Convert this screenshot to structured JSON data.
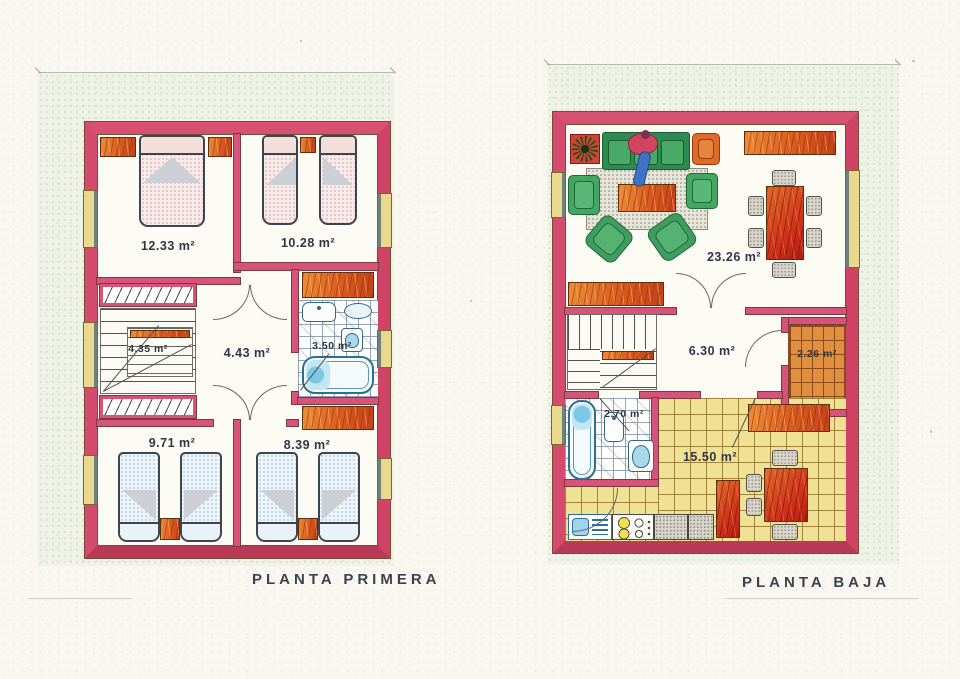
{
  "sheet": {
    "captions": {
      "first_floor": "PLANTA PRIMERA",
      "ground_floor": "PLANTA BAJA"
    }
  },
  "plans": [
    {
      "name": "PLANTA PRIMERA",
      "rooms": [
        {
          "id": "bedroom-1",
          "area": "12.33 m²"
        },
        {
          "id": "bedroom-2",
          "area": "10.28 m²"
        },
        {
          "id": "staircase",
          "area": "4.35 m²"
        },
        {
          "id": "hall",
          "area": "4.43 m²"
        },
        {
          "id": "bathroom",
          "area": "3.50 m²"
        },
        {
          "id": "bedroom-3",
          "area": "9.71 m²"
        },
        {
          "id": "bedroom-4",
          "area": "8.39 m²"
        }
      ]
    },
    {
      "name": "PLANTA BAJA",
      "rooms": [
        {
          "id": "living-dining-room",
          "area": "23.26 m²"
        },
        {
          "id": "hall",
          "area": "6.30 m²"
        },
        {
          "id": "porch",
          "area": "2.26 m²"
        },
        {
          "id": "bathroom",
          "area": "2.70 m²"
        },
        {
          "id": "kitchen",
          "area": "15.50 m²"
        }
      ]
    }
  ],
  "colors": {
    "wall_pink": "#d44b6d",
    "window_yellow": "#ead98c",
    "wood_orange": "#d85a20",
    "sofa_green": "#3f9e5f",
    "fixture_blue": "#7cc7e6",
    "kitchen_tile": "#f0e294",
    "porch_tile": "#df8f3f",
    "label_ink": "#2f3744",
    "paper": "#f9f7f0"
  }
}
